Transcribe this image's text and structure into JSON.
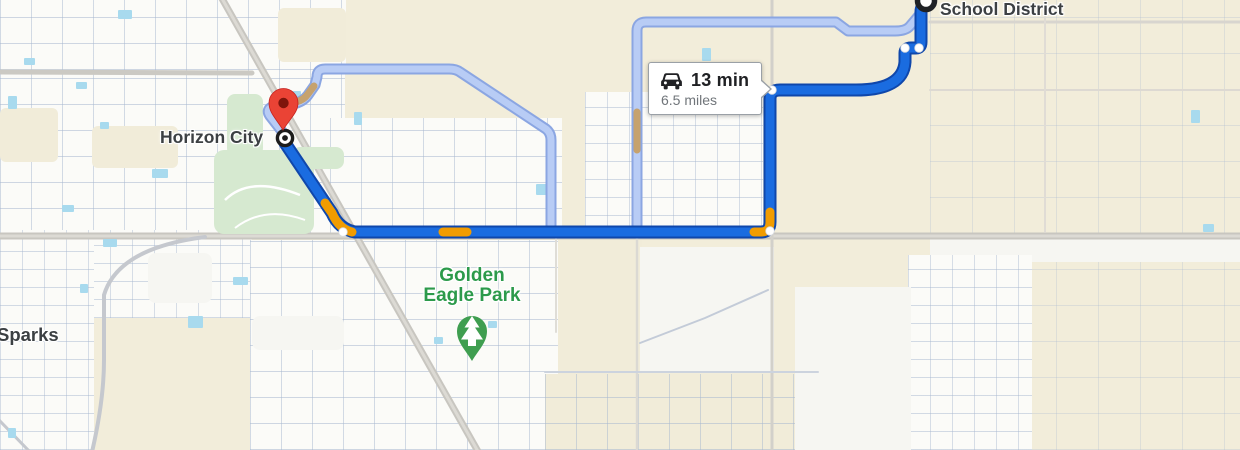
{
  "map": {
    "labels": {
      "origin_city": "Horizon City",
      "destination_area": "School District",
      "neighborhood": "Sparks",
      "park_line1": "Golden",
      "park_line2": "Eagle Park"
    },
    "route_bubble": {
      "duration": "13 min",
      "distance": "6.5 miles"
    },
    "icons": {
      "car": "car-icon",
      "origin": "origin-bullseye-icon",
      "destination": "destination-circle-icon",
      "place_pin": "red-pin-icon",
      "park_pin": "park-tree-pin-icon"
    },
    "colors": {
      "route_primary": "#1a6ce0",
      "route_primary_border": "#0f47ab",
      "route_alternate": "#b8ccf5",
      "route_alternate_border": "#8ba6e2",
      "traffic_moderate": "#f19c01",
      "traffic_alternate": "#c6a26e",
      "map_background": "#f2edda",
      "water": "#a8daee",
      "park_green": "#d6e9d0",
      "park_label_green": "#2c9a4b",
      "city_label_gray": "#3c4043"
    }
  }
}
